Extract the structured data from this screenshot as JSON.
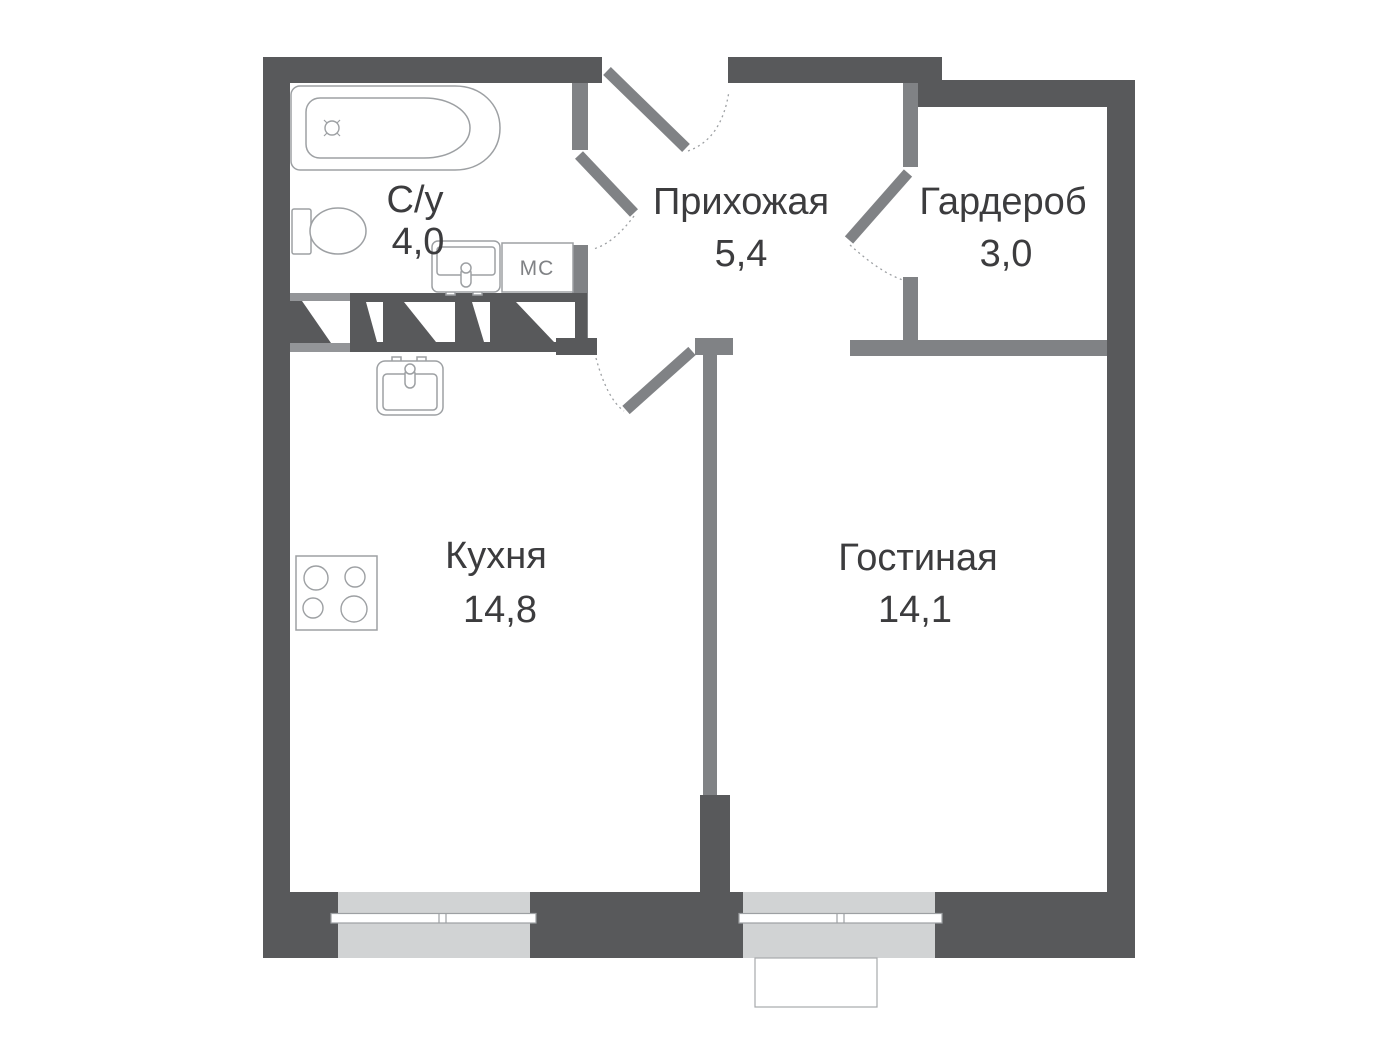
{
  "colors": {
    "wall-dark": "#58595B",
    "wall-medium": "#808285",
    "window-fill": "#D1D3D4",
    "vent-strip": "#939598",
    "fixture-stroke": "#9DA0A3",
    "text-color": "#3C3C3E",
    "bg": "#FFFFFF"
  },
  "plan": {
    "rooms": [
      {
        "name": "С/у",
        "area": "4,0"
      },
      {
        "name": "Прихожая",
        "area": "5,4"
      },
      {
        "name": "Гардероб",
        "area": "3,0"
      },
      {
        "name": "Кухня",
        "area": "14,8"
      },
      {
        "name": "Гостиная",
        "area": "14,1"
      }
    ],
    "appliance_labels": {
      "washing_machine": "МС"
    }
  }
}
